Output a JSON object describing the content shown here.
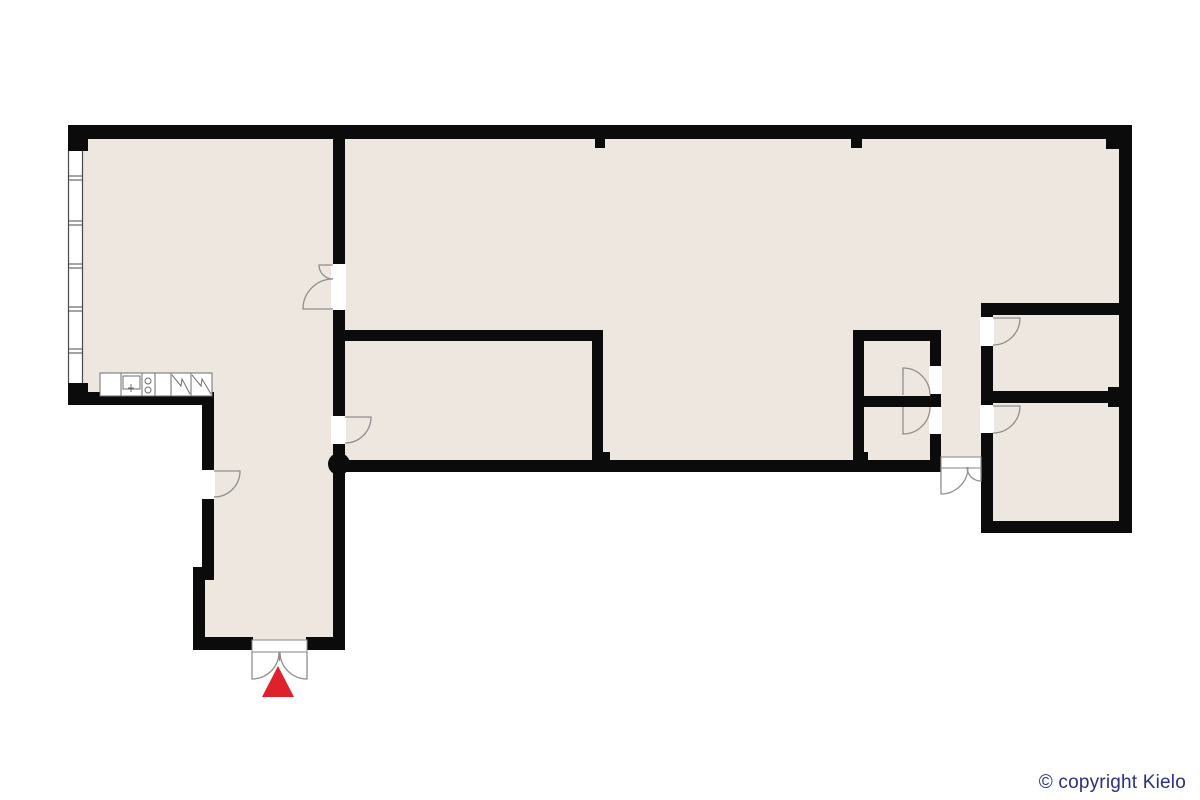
{
  "footer": {
    "copyright": "© copyright Kielo",
    "color": "#2A2F7F"
  },
  "floorplan": {
    "canvas": {
      "width": 1200,
      "height": 800
    },
    "colors": {
      "floor": "#EDE7E0",
      "wall": "#0B0B0B",
      "white": "#FFFFFF",
      "door": "#8F8F8F",
      "fixture": "#6E6E6E",
      "window": "#4A4A4A",
      "red": "#E0202A"
    },
    "shapes": [
      {
        "name": "floor-left-wing",
        "kind": "polygon",
        "points": "75,130 340,130 340,648 196,648 196,574 208,574 208,398 75,398",
        "fill": "floor"
      },
      {
        "name": "floor-main-hall",
        "kind": "polygon",
        "points": "340,130 1128,130 1128,528 985,528 985,466 340,466",
        "fill": "floor"
      },
      {
        "name": "window-band",
        "kind": "rect",
        "x": 68.5,
        "y": 150,
        "w": 14,
        "h": 234,
        "fill": "white",
        "stroke": "window",
        "sw": 1.2
      },
      {
        "name": "window-mullion",
        "kind": "path",
        "d": "M68.5,176 L82.5,176",
        "stroke": "window",
        "sw": 1
      },
      {
        "name": "window-mullion",
        "kind": "path",
        "d": "M68.5,180 L82.5,180",
        "stroke": "window",
        "sw": 1
      },
      {
        "name": "window-mullion",
        "kind": "path",
        "d": "M68.5,221 L82.5,221",
        "stroke": "window",
        "sw": 1
      },
      {
        "name": "window-mullion",
        "kind": "path",
        "d": "M68.5,225 L82.5,225",
        "stroke": "window",
        "sw": 1
      },
      {
        "name": "window-mullion",
        "kind": "path",
        "d": "M68.5,264 L82.5,264",
        "stroke": "window",
        "sw": 1
      },
      {
        "name": "window-mullion",
        "kind": "path",
        "d": "M68.5,268 L82.5,268",
        "stroke": "window",
        "sw": 1
      },
      {
        "name": "window-mullion",
        "kind": "path",
        "d": "M68.5,307 L82.5,307",
        "stroke": "window",
        "sw": 1
      },
      {
        "name": "window-mullion",
        "kind": "path",
        "d": "M68.5,311 L82.5,311",
        "stroke": "window",
        "sw": 1
      },
      {
        "name": "window-mullion",
        "kind": "path",
        "d": "M68.5,349 L82.5,349",
        "stroke": "window",
        "sw": 1
      },
      {
        "name": "window-mullion",
        "kind": "path",
        "d": "M68.5,353 L82.5,353",
        "stroke": "window",
        "sw": 1
      },
      {
        "name": "wall-top",
        "kind": "rect",
        "x": 68,
        "y": 125,
        "w": 1064,
        "h": 14,
        "fill": "wall"
      },
      {
        "name": "wall-topleft-stub",
        "kind": "rect",
        "x": 68,
        "y": 139,
        "w": 20,
        "h": 12,
        "fill": "wall"
      },
      {
        "name": "wall-bottomleft-stub",
        "kind": "rect",
        "x": 68,
        "y": 383,
        "w": 20,
        "h": 10,
        "fill": "wall"
      },
      {
        "name": "wall-kitchen-bottom",
        "kind": "rect",
        "x": 68,
        "y": 392,
        "w": 146,
        "h": 13,
        "fill": "wall"
      },
      {
        "name": "wall-corridor-left-upper",
        "kind": "rect",
        "x": 202,
        "y": 405,
        "w": 12,
        "h": 171,
        "fill": "wall"
      },
      {
        "name": "wall-corridor-step",
        "kind": "rect",
        "x": 193,
        "y": 567,
        "w": 21,
        "h": 13,
        "fill": "wall"
      },
      {
        "name": "wall-corridor-left-lower",
        "kind": "rect",
        "x": 193,
        "y": 578,
        "w": 12,
        "h": 72,
        "fill": "wall"
      },
      {
        "name": "wall-entrance-left",
        "kind": "rect",
        "x": 193,
        "y": 637,
        "w": 60,
        "h": 13,
        "fill": "wall"
      },
      {
        "name": "wall-entrance-right",
        "kind": "rect",
        "x": 306,
        "y": 637,
        "w": 39,
        "h": 13,
        "fill": "wall"
      },
      {
        "name": "wall-main-vertical-a",
        "kind": "rect",
        "x": 333,
        "y": 139,
        "w": 12,
        "h": 125,
        "fill": "wall"
      },
      {
        "name": "wall-main-vertical-b",
        "kind": "rect",
        "x": 333,
        "y": 310,
        "w": 12,
        "h": 106,
        "fill": "wall"
      },
      {
        "name": "wall-main-vertical-c",
        "kind": "rect",
        "x": 333,
        "y": 444,
        "w": 12,
        "h": 206,
        "fill": "wall"
      },
      {
        "name": "wall-middleroom-top",
        "kind": "rect",
        "x": 339,
        "y": 330,
        "w": 264,
        "h": 11,
        "fill": "wall"
      },
      {
        "name": "wall-middleroom-right",
        "kind": "rect",
        "x": 592,
        "y": 341,
        "w": 11,
        "h": 127,
        "fill": "wall"
      },
      {
        "name": "wall-middleroom-stub",
        "kind": "rect",
        "x": 603,
        "y": 452,
        "w": 7,
        "h": 10,
        "fill": "wall"
      },
      {
        "name": "wall-hall-bottom",
        "kind": "rect",
        "x": 333,
        "y": 460,
        "w": 608,
        "h": 12,
        "fill": "wall"
      },
      {
        "name": "wall-smallrooms-left",
        "kind": "rect",
        "x": 853,
        "y": 330,
        "w": 11,
        "h": 136,
        "fill": "wall"
      },
      {
        "name": "wall-smallrooms-top",
        "kind": "rect",
        "x": 853,
        "y": 330,
        "w": 88,
        "h": 11,
        "fill": "wall"
      },
      {
        "name": "wall-smallrooms-right-a",
        "kind": "rect",
        "x": 930,
        "y": 341,
        "w": 11,
        "h": 25,
        "fill": "wall"
      },
      {
        "name": "wall-smallrooms-right-b",
        "kind": "rect",
        "x": 930,
        "y": 394,
        "w": 11,
        "h": 13,
        "fill": "wall"
      },
      {
        "name": "wall-smallrooms-right-c",
        "kind": "rect",
        "x": 930,
        "y": 434,
        "w": 11,
        "h": 32,
        "fill": "wall"
      },
      {
        "name": "wall-smallrooms-divider",
        "kind": "rect",
        "x": 853,
        "y": 396,
        "w": 88,
        "h": 11,
        "fill": "wall"
      },
      {
        "name": "wall-smallrooms-stub",
        "kind": "rect",
        "x": 853,
        "y": 452,
        "w": 15,
        "h": 10,
        "fill": "wall"
      },
      {
        "name": "wall-rightrooms-left-a",
        "kind": "rect",
        "x": 981,
        "y": 303,
        "w": 12,
        "h": 14,
        "fill": "wall"
      },
      {
        "name": "wall-rightrooms-left-b",
        "kind": "rect",
        "x": 981,
        "y": 346,
        "w": 12,
        "h": 59,
        "fill": "wall"
      },
      {
        "name": "wall-rightrooms-left-c",
        "kind": "rect",
        "x": 981,
        "y": 433,
        "w": 12,
        "h": 89,
        "fill": "wall"
      },
      {
        "name": "wall-rightrooms-top",
        "kind": "rect",
        "x": 981,
        "y": 303,
        "w": 151,
        "h": 12,
        "fill": "wall"
      },
      {
        "name": "wall-rightrooms-divider",
        "kind": "rect",
        "x": 993,
        "y": 391,
        "w": 129,
        "h": 12,
        "fill": "wall"
      },
      {
        "name": "wall-divider-pilaster",
        "kind": "rect",
        "x": 1108,
        "y": 387,
        "w": 14,
        "h": 20,
        "fill": "wall"
      },
      {
        "name": "wall-right",
        "kind": "rect",
        "x": 1119,
        "y": 125,
        "w": 13,
        "h": 408,
        "fill": "wall"
      },
      {
        "name": "wall-rightrooms-bottom",
        "kind": "rect",
        "x": 981,
        "y": 521,
        "w": 151,
        "h": 12,
        "fill": "wall"
      },
      {
        "name": "wall-topright-notch",
        "kind": "rect",
        "x": 1106,
        "y": 139,
        "w": 13,
        "h": 10,
        "fill": "wall"
      },
      {
        "name": "wall-top-stub-1",
        "kind": "rect",
        "x": 595,
        "y": 139,
        "w": 10,
        "h": 9,
        "fill": "wall"
      },
      {
        "name": "wall-top-stub-2",
        "kind": "rect",
        "x": 851,
        "y": 139,
        "w": 11,
        "h": 9,
        "fill": "wall"
      },
      {
        "name": "column",
        "kind": "circle",
        "cx": 339,
        "cy": 464,
        "r": 11,
        "fill": "wall"
      },
      {
        "name": "door-opening-main-double",
        "kind": "rect",
        "x": 331,
        "y": 264,
        "w": 15,
        "h": 46,
        "fill": "white"
      },
      {
        "name": "door-opening-corridor",
        "kind": "rect",
        "x": 200,
        "y": 470,
        "w": 15,
        "h": 29,
        "fill": "white"
      },
      {
        "name": "door-opening-middleroom",
        "kind": "rect",
        "x": 331,
        "y": 416,
        "w": 15,
        "h": 28,
        "fill": "white"
      },
      {
        "name": "door-opening-upper-small",
        "kind": "rect",
        "x": 929,
        "y": 366,
        "w": 13,
        "h": 28,
        "fill": "white"
      },
      {
        "name": "door-opening-lower-small",
        "kind": "rect",
        "x": 929,
        "y": 407,
        "w": 13,
        "h": 27,
        "fill": "white"
      },
      {
        "name": "door-opening-topright",
        "kind": "rect",
        "x": 980,
        "y": 317,
        "w": 14,
        "h": 29,
        "fill": "white"
      },
      {
        "name": "door-opening-bottomright",
        "kind": "rect",
        "x": 980,
        "y": 405,
        "w": 14,
        "h": 28,
        "fill": "white"
      },
      {
        "name": "door-swing-main-small-leaf",
        "kind": "path",
        "d": "M333,265 L319,265 A14,14 0 0 0 333,279",
        "stroke": "door",
        "sw": 1.3
      },
      {
        "name": "door-swing-main-large-leaf",
        "kind": "path",
        "d": "M333,309 L303,309 A30,30 0 0 1 333,279",
        "stroke": "door",
        "sw": 1.3
      },
      {
        "name": "door-swing-corridor",
        "kind": "path",
        "d": "M214,471 L240,471 A26,26 0 0 1 214,497",
        "stroke": "door",
        "sw": 1.3
      },
      {
        "name": "door-swing-middleroom",
        "kind": "path",
        "d": "M345,417 L371,417 A26,26 0 0 1 345,443",
        "stroke": "door",
        "sw": 1.3
      },
      {
        "name": "door-swing-upper-small",
        "kind": "path",
        "d": "M903,395 L903,368 A27,27 0 0 1 930,395",
        "stroke": "door",
        "sw": 1.3
      },
      {
        "name": "door-swing-lower-small",
        "kind": "path",
        "d": "M903,407 L903,434 A27,27 0 0 0 930,407",
        "stroke": "door",
        "sw": 1.3
      },
      {
        "name": "door-swing-topright",
        "kind": "path",
        "d": "M993,318 L1020,318 A27,27 0 0 1 993,345",
        "stroke": "door",
        "sw": 1.3
      },
      {
        "name": "door-swing-bottomright",
        "kind": "path",
        "d": "M993,406 L1020,406 A27,27 0 0 1 993,433",
        "stroke": "door",
        "sw": 1.3
      },
      {
        "name": "threshold-side-exit",
        "kind": "rect",
        "x": 941,
        "y": 457,
        "w": 40,
        "h": 11,
        "fill": "white",
        "stroke": "door",
        "sw": 1.1
      },
      {
        "name": "door-swing-side-exit-large",
        "kind": "path",
        "d": "M941,467 L941,494 A27,27 0 0 0 968,467",
        "stroke": "door",
        "sw": 1.3
      },
      {
        "name": "door-swing-side-exit-small",
        "kind": "path",
        "d": "M981,467 L981,481 A14,14 0 0 1 967,467",
        "stroke": "door",
        "sw": 1.3
      },
      {
        "name": "threshold-entrance",
        "kind": "rect",
        "x": 252,
        "y": 640,
        "w": 55,
        "h": 12,
        "fill": "white",
        "stroke": "door",
        "sw": 1.1
      },
      {
        "name": "door-swing-entrance-left",
        "kind": "path",
        "d": "M252,652 L252,679 A27,27 0 0 0 279,652",
        "stroke": "door",
        "sw": 1.3
      },
      {
        "name": "door-swing-entrance-right",
        "kind": "path",
        "d": "M307,652 L307,679 A27,27 0 0 1 280,652",
        "stroke": "door",
        "sw": 1.3
      },
      {
        "name": "door-entrance-stile",
        "kind": "path",
        "d": "M279.5,652 L279.5,661",
        "stroke": "door",
        "sw": 1.3
      },
      {
        "name": "kitchen-counter",
        "kind": "rect",
        "x": 100,
        "y": 373,
        "w": 112,
        "h": 23,
        "fill": "white",
        "stroke": "fixture",
        "sw": 1
      },
      {
        "name": "counter-divider",
        "kind": "path",
        "d": "M121,373 L121,396",
        "stroke": "fixture",
        "sw": 1
      },
      {
        "name": "counter-divider",
        "kind": "path",
        "d": "M142,373 L142,396",
        "stroke": "fixture",
        "sw": 1
      },
      {
        "name": "counter-divider",
        "kind": "path",
        "d": "M155,373 L155,396",
        "stroke": "fixture",
        "sw": 1
      },
      {
        "name": "counter-divider",
        "kind": "path",
        "d": "M171,373 L171,396",
        "stroke": "fixture",
        "sw": 1
      },
      {
        "name": "counter-divider",
        "kind": "path",
        "d": "M191,373 L191,396",
        "stroke": "fixture",
        "sw": 1
      },
      {
        "name": "sink",
        "kind": "rect",
        "x": 123,
        "y": 376,
        "w": 17,
        "h": 13,
        "fill": "none",
        "stroke": "fixture",
        "sw": 1
      },
      {
        "name": "sink-faucet",
        "kind": "path",
        "d": "M131,384 L131,392",
        "stroke": "fixture",
        "sw": 1
      },
      {
        "name": "sink-faucet",
        "kind": "path",
        "d": "M128,388 L134,388",
        "stroke": "fixture",
        "sw": 1
      },
      {
        "name": "stove-burner",
        "kind": "circle",
        "cx": 148,
        "cy": 381,
        "r": 3,
        "fill": "none",
        "stroke": "fixture",
        "sw": 1
      },
      {
        "name": "stove-burner",
        "kind": "circle",
        "cx": 148,
        "cy": 390,
        "r": 3,
        "fill": "none",
        "stroke": "fixture",
        "sw": 1
      },
      {
        "name": "appliance-symbol",
        "kind": "polyline",
        "points": "172,375 181,386 182,379 190,394",
        "stroke": "fixture",
        "sw": 1
      },
      {
        "name": "appliance-symbol",
        "kind": "polyline",
        "points": "192,375 201,386 202,379 211,394",
        "stroke": "fixture",
        "sw": 1
      },
      {
        "name": "entrance-arrow",
        "kind": "polygon",
        "points": "278,666 262,697 294,697",
        "fill": "red"
      }
    ]
  }
}
